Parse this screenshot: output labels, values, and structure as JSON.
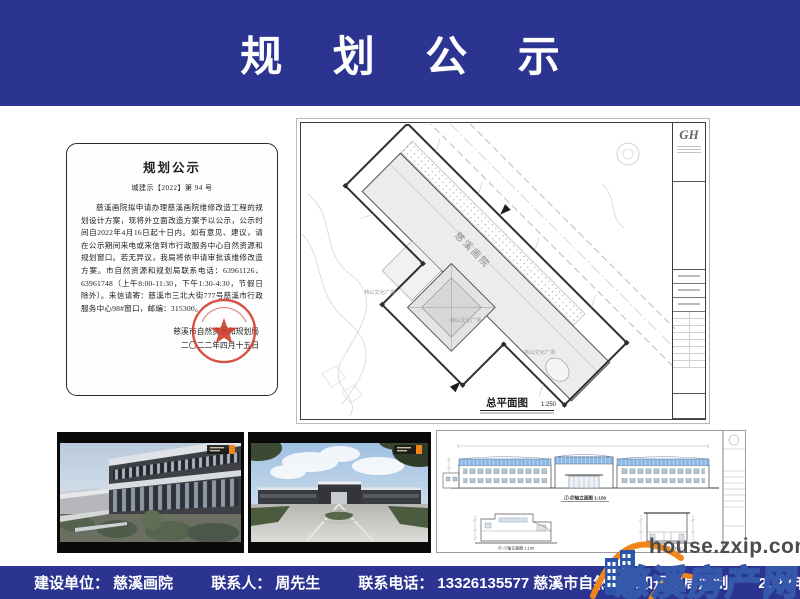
{
  "header": {
    "title": "规 划 公 示"
  },
  "notice": {
    "title": "规划公示",
    "doc_no": "城建示【2022】第 94 号",
    "body": "慈溪画院拟申请办理慈溪画院维修改造工程的规划设计方案，现将外立面改造方案予以公示，公示时间自2022年4月16日起十日内。如有意见、建议，请在公示期间来电或来信到市行政服务中心自然资源和规划窗口。若无异议，我局将依申请审批该维修改造方案。市自然资源和规划局联系电话：63961126、63961748（上午8:00-11:30，下午1:30-4:30，节假日除外）。来信请寄：慈溪市三北大街777号慈溪市行政服务中心98#窗口，邮编：315300。",
    "signature": "慈溪市自然资源和规划局",
    "date": "二〇二二年四月十五日"
  },
  "site_plan": {
    "sheet_logo": "GH",
    "building_label": "慈溪画院",
    "plaza_labels": [
      "峙山文化广场",
      "峙山文化广场",
      "峙山文化广场"
    ],
    "title": "总平面图",
    "scale": "1:250"
  },
  "elevations": {
    "main_label": "①-⑰轴立面图 1:150",
    "section_label_1": "⑰-①轴立面图 1:150",
    "section_label_2": "1-1剖面图 1:150"
  },
  "footer": {
    "builder_label": "建设单位：",
    "builder_value": "慈溪画院",
    "contact_label": "联系人：",
    "contact_value": "周先生",
    "phone_label": "联系电话：",
    "phone_value": "13326135577",
    "producer": "慈溪市自然资源和规划局监制",
    "date": "2022年4月15日"
  },
  "watermark": {
    "url": "house.zxip.com",
    "site_name": "慈溪房产网"
  },
  "colors": {
    "banner-blue": "#2b3490",
    "seal-red": "#d03a28",
    "roof-blue": "#8cb9e8",
    "wm-orange": "#f08519",
    "wm-blue": "#3558ab"
  }
}
